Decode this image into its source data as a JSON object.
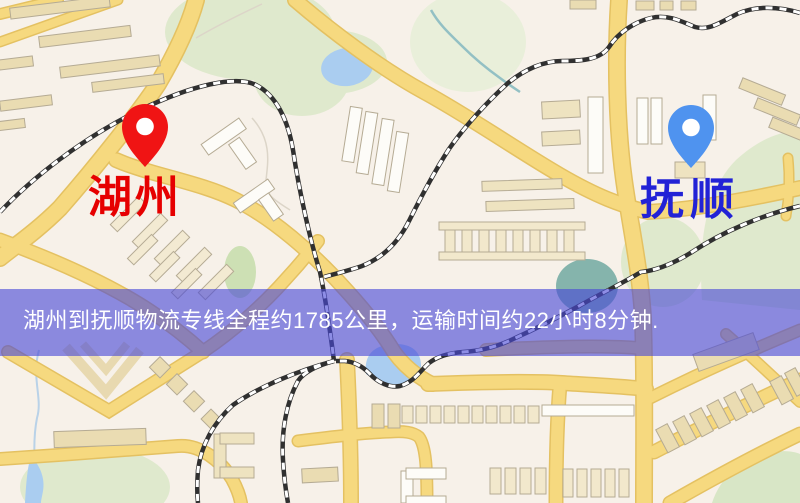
{
  "markers": {
    "origin": {
      "label": "湖州",
      "pin_color": "#f01414",
      "label_color": "#e60000"
    },
    "destination": {
      "label": "抚顺",
      "pin_color": "#4f93ef",
      "label_color": "#2222d6"
    }
  },
  "banner": {
    "text": "湖州到抚顺物流专线全程约1785公里，运输时间约22小时8分钟.",
    "background_color": "rgba(72,72,214,0.62)",
    "text_color": "#ffffff"
  },
  "map_palette": {
    "land": "#f7f1e9",
    "road_fill": "#f6d97f",
    "road_casing": "#e4c162",
    "building_tan": "#eadcb2",
    "building_white": "#fdfcf8",
    "park_green": "#dfe9cd",
    "water_blue": "#aacdf0",
    "water_teal": "#85b4ac",
    "railway_dark": "#303030",
    "railway_light": "#ffffff"
  }
}
